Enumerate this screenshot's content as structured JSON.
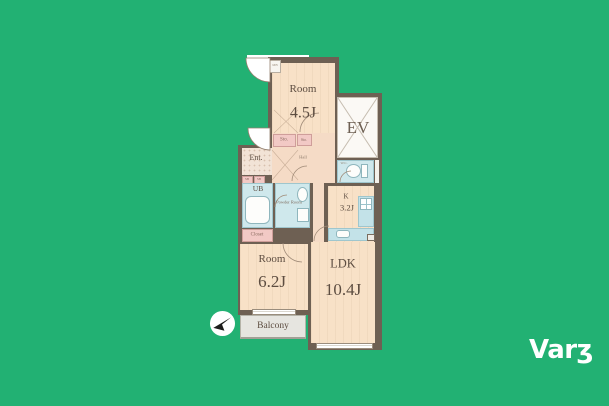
{
  "canvas": {
    "background_color": "#22b173"
  },
  "brand": {
    "logo_text": "Varʒ",
    "logo_color": "#ffffff"
  },
  "floorplan": {
    "labels": {
      "room_a": {
        "name": "Room",
        "area": "4.5J"
      },
      "room_b": {
        "name": "Room",
        "area": "6.2J"
      },
      "ldk": {
        "name": "LDK",
        "area": "10.4J"
      },
      "kitchen": {
        "name": "K",
        "area": "3.2J"
      },
      "elevator": "EV",
      "entrance": "Ent.",
      "hall": "Hall",
      "storage_1": "Sto.",
      "storage_2": "Sto.",
      "shoe_box_1": "SB",
      "shoe_box_2": "SB",
      "unit_bath": "UB",
      "powder_room": "Powder Room",
      "wc": "W.C.",
      "closet": "Closet",
      "balcony": "Balcony",
      "meter_box": "MB"
    },
    "colors": {
      "wall": "#6e6053",
      "room_floor": "#f8e1c7",
      "hall_floor": "#f5dbc6",
      "wet_area": "#cfe8ec",
      "storage_pink": "#f2c9c5",
      "balcony_gray": "#e6e5e0",
      "elevator_white": "#fbf9f5",
      "label_text": "#5d4d41"
    }
  }
}
